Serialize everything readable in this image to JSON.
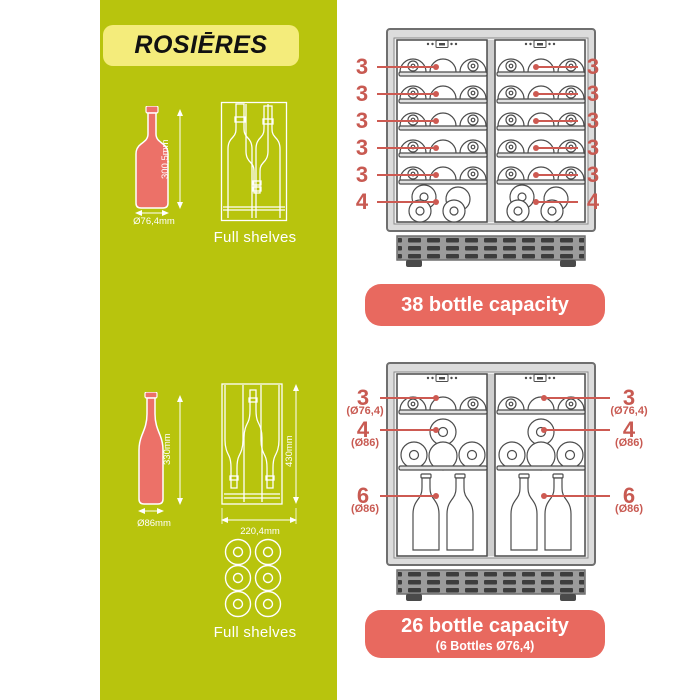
{
  "brand": {
    "logo_text": "ROSIĒRES"
  },
  "colors": {
    "panel_green": "#b8c40d",
    "logo_yellow": "#f4ec7b",
    "badge_salmon": "#e8695f",
    "label_red": "#c85a52",
    "bottle_fill": "#ec7168"
  },
  "left_panel": {
    "bordeaux_bottle": {
      "height_label": "300,5mm",
      "diameter_label": "Ø76,4mm"
    },
    "shelf1_caption": "Full shelves",
    "burgundy_bottle": {
      "height_label": "330mm",
      "diameter_label": "Ø86mm"
    },
    "shelf2": {
      "height_label": "430mm",
      "width_label": "220,4mm"
    },
    "shelf2_caption": "Full shelves"
  },
  "cooler1": {
    "badge_label": "38 bottle capacity",
    "left_labels": [
      "3",
      "3",
      "3",
      "3",
      "3",
      "4"
    ],
    "right_labels": [
      "3",
      "3",
      "3",
      "3",
      "3",
      "4"
    ]
  },
  "cooler2": {
    "badge_label": "26 bottle capacity",
    "badge_sublabel": "(6 Bottles Ø76,4)",
    "left_labels": [
      {
        "count": "3",
        "diameter": "(Ø76,4)"
      },
      {
        "count": "4",
        "diameter": "(Ø86)"
      },
      {
        "count": "6",
        "diameter": "(Ø86)"
      }
    ],
    "right_labels": [
      {
        "count": "3",
        "diameter": "(Ø76,4)"
      },
      {
        "count": "4",
        "diameter": "(Ø86)"
      },
      {
        "count": "6",
        "diameter": "(Ø86)"
      }
    ]
  }
}
